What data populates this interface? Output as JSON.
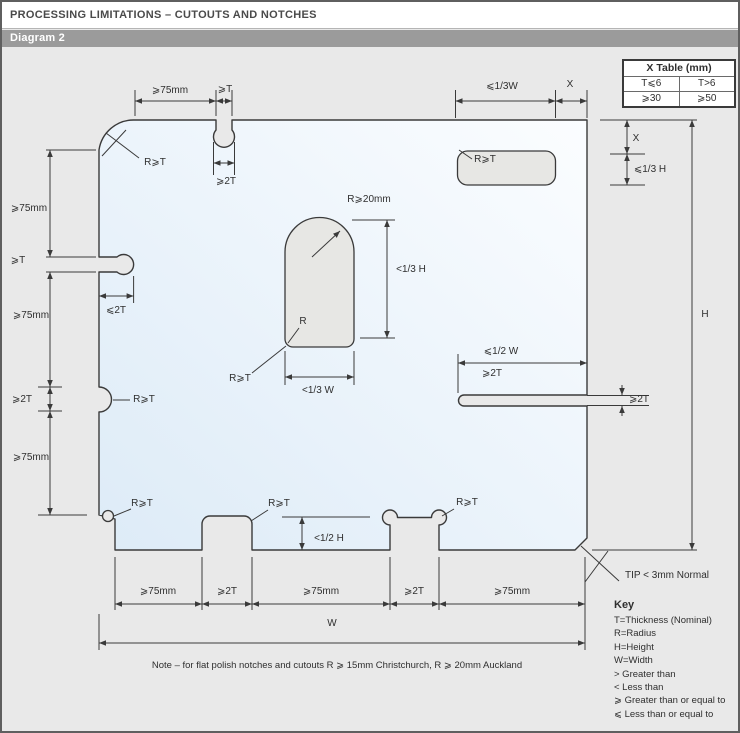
{
  "header": {
    "title": "PROCESSING LIMITATIONS – CUTOUTS AND NOTCHES",
    "diagram_label": "Diagram 2"
  },
  "x_table": {
    "title": "X Table (mm)",
    "col1_header": "T⩽6",
    "col2_header": "T>6",
    "col1_value": "⩾30",
    "col2_value": "⩾50"
  },
  "key": {
    "title": "Key",
    "lines": [
      "T=Thickness (Nominal)",
      "R=Radius",
      "H=Height",
      "W=Width",
      "> Greater than",
      "< Less than",
      "⩾ Greater than or equal to",
      "⩽ Less than or equal to"
    ]
  },
  "note": "Note – for flat polish notches and cutouts R ⩾ 15mm Christchurch, R ⩾ 20mm Auckland",
  "colors": {
    "background": "#e9e9e9",
    "bar": "#9b9b9b",
    "line": "#3a3a3a",
    "glass_fill_start": "#ddebf7",
    "glass_fill_end": "#fbfdff",
    "cutout_fill": "#e7e7e4"
  },
  "labels": [
    {
      "id": "dim-top-left-75mm",
      "text": "⩾75mm",
      "x": 168,
      "y": 89
    },
    {
      "id": "dim-top-notch-t",
      "text": "⩾T",
      "x": 223,
      "y": 88
    },
    {
      "id": "dim-top-notch-2t",
      "text": "⩾2T",
      "x": 224,
      "y": 180
    },
    {
      "id": "label-top-left-radius",
      "text": "R⩾T",
      "x": 153,
      "y": 161
    },
    {
      "id": "dim-cutout-width",
      "text": "⩽1/3W",
      "x": 500,
      "y": 85
    },
    {
      "id": "dim-cutout-offset-x-top",
      "text": "X",
      "x": 568,
      "y": 83
    },
    {
      "id": "label-cutout-radius",
      "text": "R⩾T",
      "x": 483,
      "y": 158
    },
    {
      "id": "dim-cutout-offset-x-right",
      "text": "X",
      "x": 634,
      "y": 137
    },
    {
      "id": "dim-cutout-height",
      "text": "⩽1/3 H",
      "x": 648,
      "y": 168
    },
    {
      "id": "dim-height",
      "text": "H",
      "x": 703,
      "y": 313
    },
    {
      "id": "label-keyhole-radius",
      "text": "R⩾20mm",
      "x": 367,
      "y": 198
    },
    {
      "id": "dim-keyhole-height",
      "text": "<1/3 H",
      "x": 409,
      "y": 268
    },
    {
      "id": "label-keyhole-r",
      "text": "R",
      "x": 301,
      "y": 320
    },
    {
      "id": "label-keyhole-corner-radius",
      "text": "R⩾T",
      "x": 238,
      "y": 377
    },
    {
      "id": "dim-keyhole-width",
      "text": "<1/3 W",
      "x": 316,
      "y": 389
    },
    {
      "id": "dim-slot-length",
      "text": "⩽1/2 W",
      "x": 499,
      "y": 350
    },
    {
      "id": "dim-slot-2t",
      "text": "⩾2T",
      "x": 490,
      "y": 372
    },
    {
      "id": "dim-slot-height",
      "text": "⩾2T",
      "x": 637,
      "y": 398
    },
    {
      "id": "dim-left-75-1",
      "text": "⩾75mm",
      "x": 27,
      "y": 207
    },
    {
      "id": "dim-left-t",
      "text": "⩾T",
      "x": 16,
      "y": 259
    },
    {
      "id": "dim-left-75-2",
      "text": "⩾75mm",
      "x": 29,
      "y": 314
    },
    {
      "id": "dim-left-2t",
      "text": "⩾2T",
      "x": 20,
      "y": 398
    },
    {
      "id": "dim-left-75-3",
      "text": "⩾75mm",
      "x": 29,
      "y": 456
    },
    {
      "id": "dim-left-slot-depth",
      "text": "⩽2T",
      "x": 114,
      "y": 309
    },
    {
      "id": "label-left-notch-radius",
      "text": "R⩾T",
      "x": 142,
      "y": 398
    },
    {
      "id": "label-bottom-left-radius",
      "text": "R⩾T",
      "x": 140,
      "y": 502
    },
    {
      "id": "label-bottom-notch1-radius",
      "text": "R⩾T",
      "x": 277,
      "y": 502
    },
    {
      "id": "label-bottom-notch2-radius",
      "text": "R⩾T",
      "x": 465,
      "y": 501
    },
    {
      "id": "dim-bottom-notch-depth",
      "text": "<1/2 H",
      "x": 327,
      "y": 537
    },
    {
      "id": "dim-bottom-75-1",
      "text": "⩾75mm",
      "x": 156,
      "y": 590
    },
    {
      "id": "dim-bottom-2t-1",
      "text": "⩾2T",
      "x": 225,
      "y": 590
    },
    {
      "id": "dim-bottom-75-2",
      "text": "⩾75mm",
      "x": 319,
      "y": 590
    },
    {
      "id": "dim-bottom-2t-2",
      "text": "⩾2T",
      "x": 412,
      "y": 590
    },
    {
      "id": "dim-bottom-75-3",
      "text": "⩾75mm",
      "x": 510,
      "y": 590
    },
    {
      "id": "dim-width",
      "text": "W",
      "x": 330,
      "y": 622
    },
    {
      "id": "tip-note",
      "text": "TIP < 3mm Normal",
      "x": 623,
      "y": 574,
      "align": "left"
    }
  ]
}
